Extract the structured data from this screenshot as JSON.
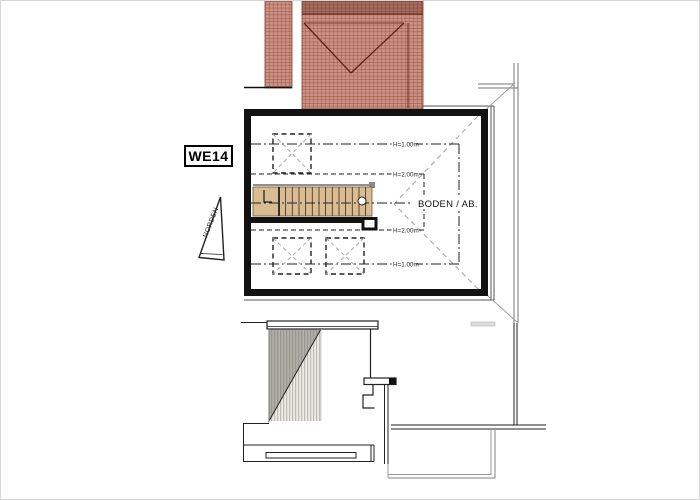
{
  "unit_label": {
    "text": "WE14"
  },
  "north_arrow": {
    "label": "NORDEN"
  },
  "room": {
    "label": "BODEN / AB."
  },
  "height_markers": [
    {
      "label": "H=1.00m"
    },
    {
      "label": "H=2.00m"
    },
    {
      "label": "H=2.00m"
    },
    {
      "label": "H=1.00m"
    }
  ],
  "colors": {
    "roof_tile": "#cb9183",
    "roof_tile_grid": "#8a4236",
    "roof_valley": "#5e241a",
    "stair_fill": "#d9bc92",
    "stair_riser": "#4a3a26",
    "wall": "#121212",
    "thin_line": "#444444",
    "gray_line": "#999999",
    "hatch_stripe": "#bdbdb4",
    "background": "#ffffff"
  }
}
